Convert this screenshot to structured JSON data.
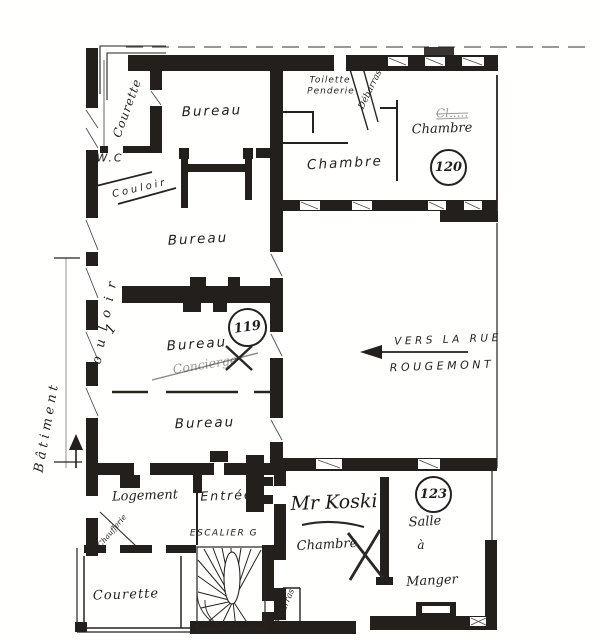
{
  "colors": {
    "ink": "#1f1d1b",
    "paper": "#fffffe"
  },
  "floorplan": {
    "building": {
      "name": "Bâtiment",
      "number": "1"
    },
    "street": {
      "line1": "VERS  LA  RUE",
      "line2": "ROUGEMONT"
    },
    "room_numbers": {
      "r119": "119",
      "r120": "120",
      "r123": "123"
    },
    "rooms": {
      "courette_top": "Courette",
      "wc": "W.C",
      "couloir_upper": "Couloir",
      "couloir_side": "Couloir",
      "bureau_top": "Bureau",
      "toilette_line1": "Toilette",
      "toilette_line2": "Penderie",
      "debarras_top": "Débarras",
      "chambre_top": "Chambre",
      "chambre_120": "Chambre",
      "bureau_2": "Bureau",
      "bureau_3": "Bureau",
      "bureau_4": "Bureau",
      "logement": "Logement",
      "entree": "Entrée",
      "escalier": "ESCALIER  G",
      "chaufferie": "Chaufferie",
      "courette_bottom": "Courette",
      "chambre_bottom": "Chambre",
      "salle_line1": "Salle",
      "salle_line2": "à",
      "salle_line3": "Manger",
      "debarras_bottom": "Débarras"
    },
    "annotations": {
      "scribble_120": "Cl.....",
      "scribble_119": "Concierge",
      "tenant": "Mr Koski"
    }
  }
}
